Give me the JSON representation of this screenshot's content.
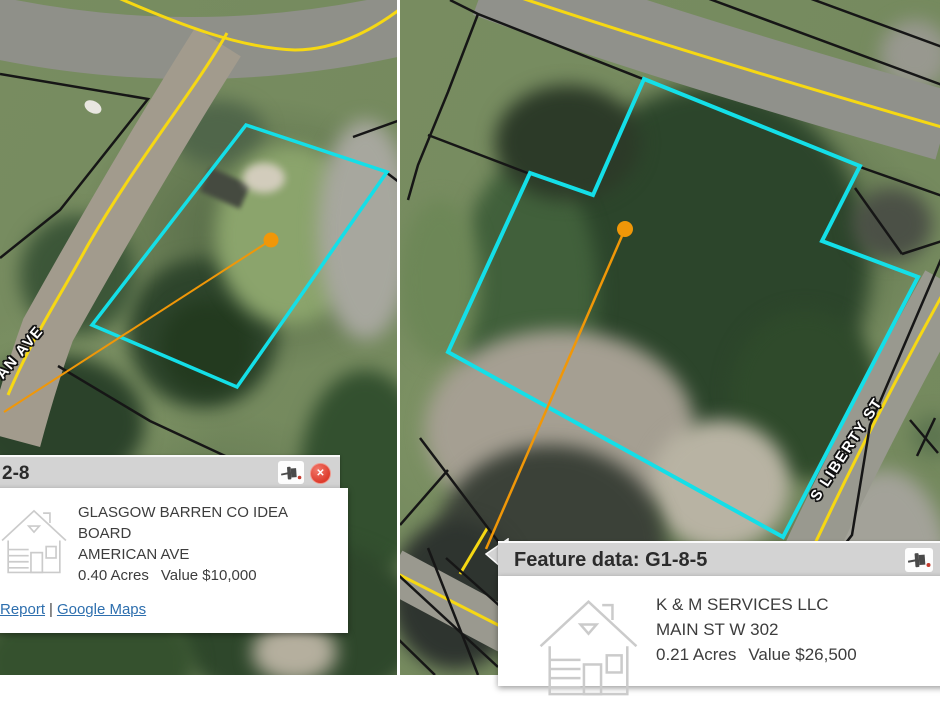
{
  "left_map": {
    "street_label": "AN AVE",
    "popup": {
      "title": "2-8",
      "owner": "GLASGOW BARREN CO IDEA BOARD",
      "address": "AMERICAN AVE",
      "acres": "0.40 Acres",
      "value": "Value $10,000",
      "link_report": "Report",
      "link_separator": "|",
      "link_google_maps": "Google Maps",
      "close_glyph": "✕"
    }
  },
  "right_map": {
    "street_label": "S LIBERTY ST",
    "popup": {
      "title": "Feature data: G1-8-5",
      "owner": "K & M SERVICES LLC",
      "address": "MAIN ST W 302",
      "acres": "0.21 Acres",
      "value": "Value $26,500"
    }
  },
  "colors": {
    "parcel_highlight_cyan": "#14dfe8",
    "parcel_boundary_black": "#161616",
    "road_centerline_yellow": "#f6d813",
    "marker_orange": "#f09708",
    "popup_header_gray": "#d3d3d3",
    "link_blue": "#2e6fae",
    "close_red": "#dd3b2c"
  }
}
